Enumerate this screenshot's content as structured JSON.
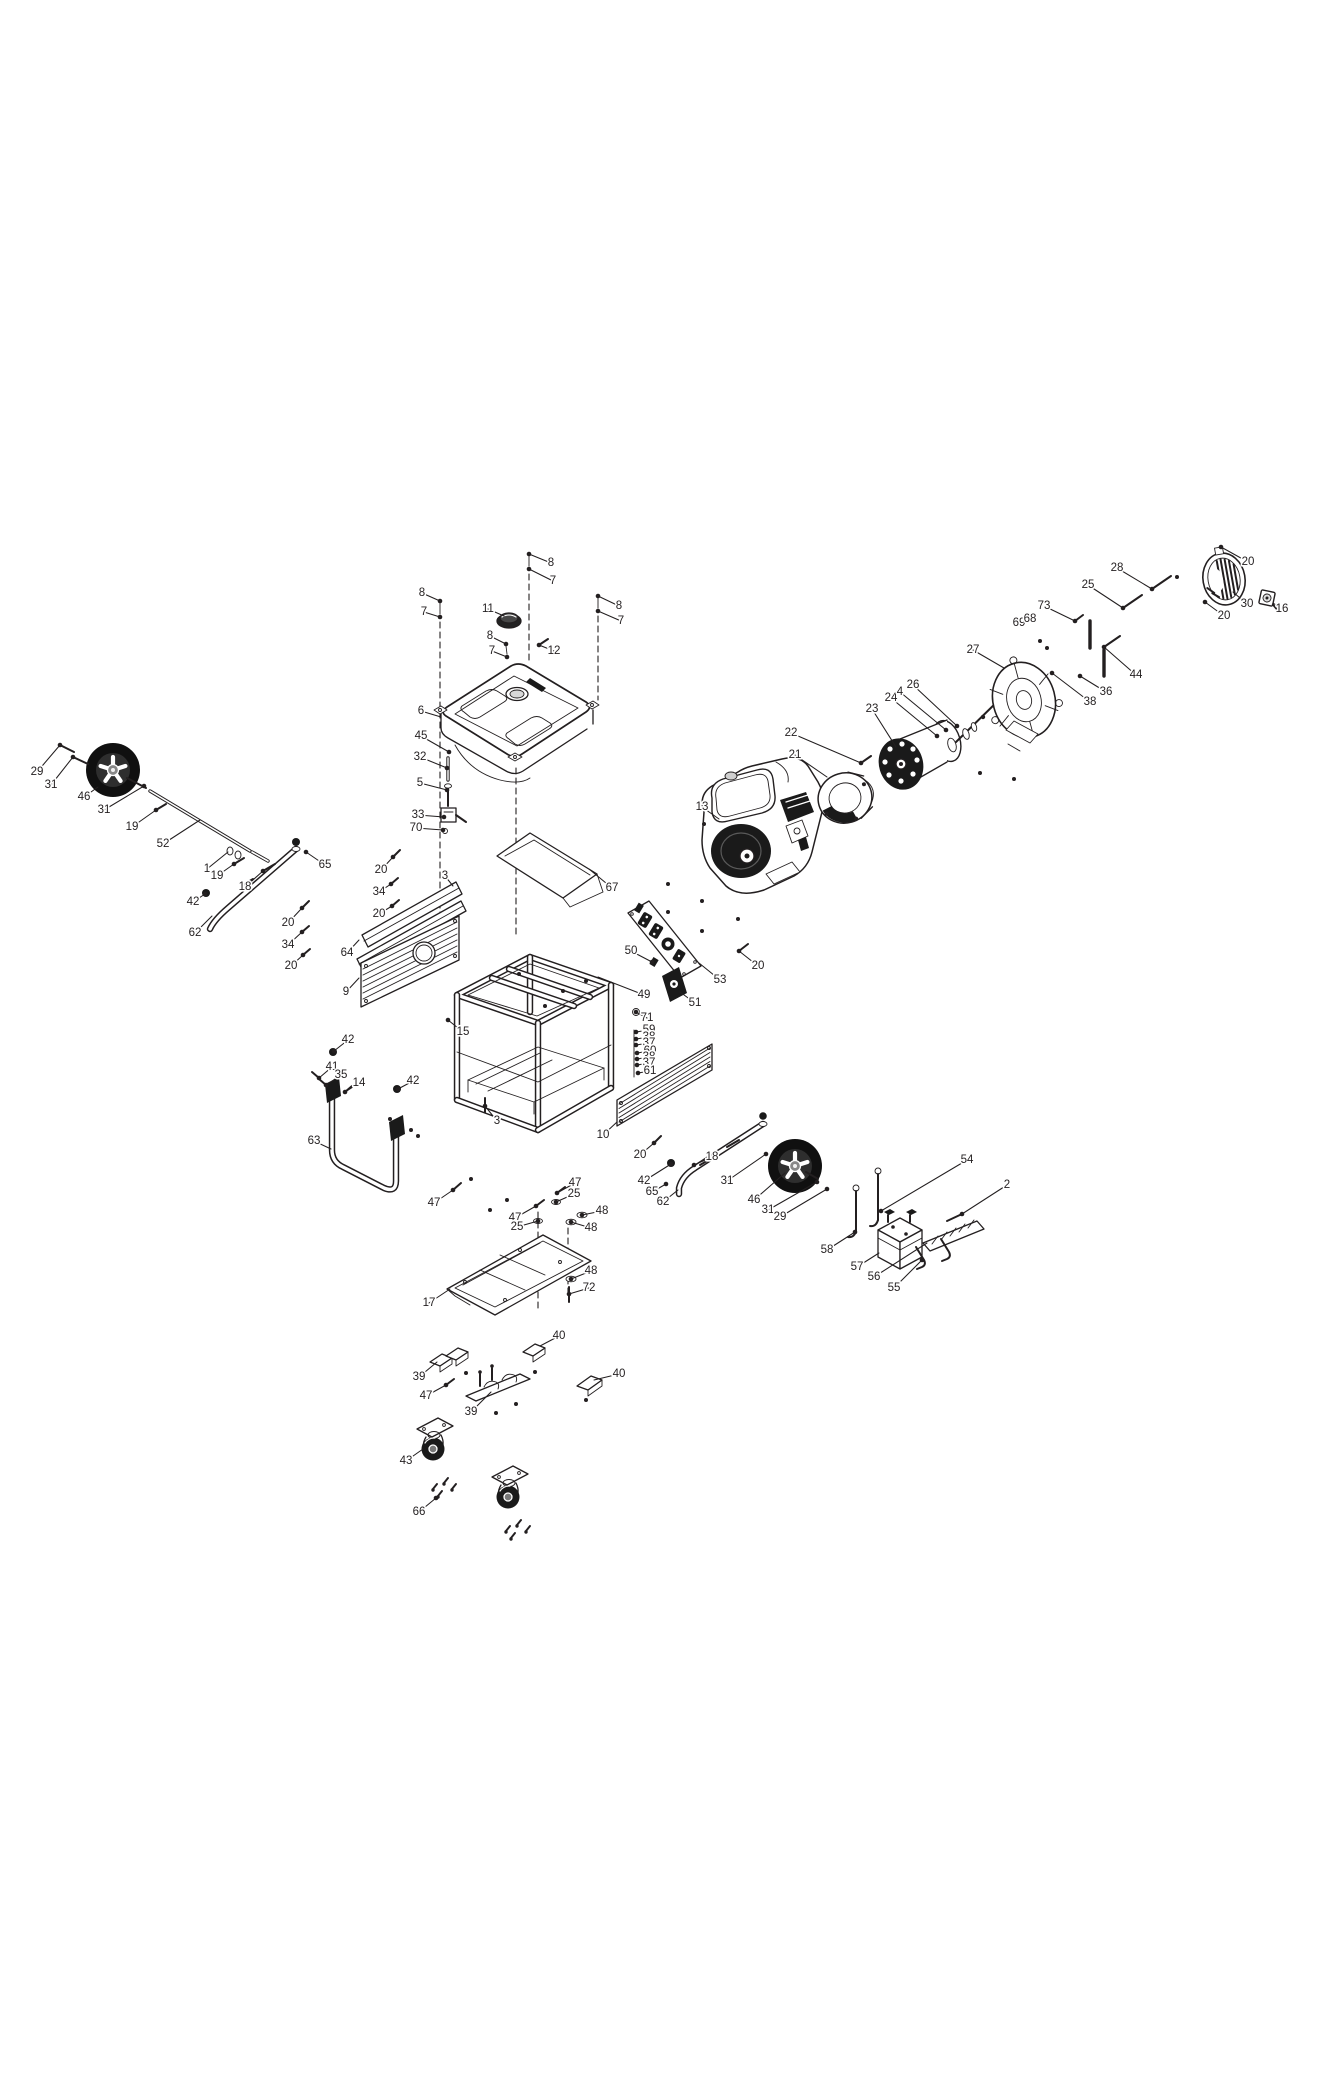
{
  "diagram": {
    "background": "#ffffff",
    "line_color": "#231f20",
    "callouts": [
      {
        "n": "8",
        "x": 422,
        "y": 593,
        "tx": 440,
        "ty": 601,
        "d": 1
      },
      {
        "n": "7",
        "x": 424,
        "y": 612,
        "tx": 440,
        "ty": 617,
        "d": 1
      },
      {
        "n": "8",
        "x": 551,
        "y": 563,
        "tx": 529,
        "ty": 554,
        "d": 1
      },
      {
        "n": "7",
        "x": 553,
        "y": 581,
        "tx": 529,
        "ty": 569,
        "d": 1
      },
      {
        "n": "8",
        "x": 619,
        "y": 606,
        "tx": 598,
        "ty": 596,
        "d": 1
      },
      {
        "n": "7",
        "x": 621,
        "y": 621,
        "tx": 598,
        "ty": 611,
        "d": 1
      },
      {
        "n": "11",
        "x": 488,
        "y": 609,
        "tx": 504,
        "ty": 616
      },
      {
        "n": "12",
        "x": 554,
        "y": 651,
        "tx": 539,
        "ty": 645,
        "d": 1
      },
      {
        "n": "8",
        "x": 490,
        "y": 636,
        "tx": 506,
        "ty": 644,
        "d": 1
      },
      {
        "n": "7",
        "x": 492,
        "y": 651,
        "tx": 507,
        "ty": 657,
        "d": 1
      },
      {
        "n": "6",
        "x": 421,
        "y": 711,
        "tx": 441,
        "ty": 717
      },
      {
        "n": "45",
        "x": 421,
        "y": 736,
        "tx": 449,
        "ty": 752,
        "d": 1
      },
      {
        "n": "32",
        "x": 420,
        "y": 757,
        "tx": 447,
        "ty": 768,
        "d": 1
      },
      {
        "n": "5",
        "x": 420,
        "y": 783,
        "tx": 447,
        "ty": 790,
        "d": 1
      },
      {
        "n": "33",
        "x": 418,
        "y": 815,
        "tx": 444,
        "ty": 817,
        "d": 1
      },
      {
        "n": "70",
        "x": 416,
        "y": 828,
        "tx": 443,
        "ty": 830,
        "d": 1
      },
      {
        "n": "29",
        "x": 37,
        "y": 772,
        "tx": 60,
        "ty": 745,
        "d": 1
      },
      {
        "n": "31",
        "x": 51,
        "y": 785,
        "tx": 73,
        "ty": 757,
        "d": 1
      },
      {
        "n": "46",
        "x": 84,
        "y": 797,
        "tx": 98,
        "ty": 787
      },
      {
        "n": "31",
        "x": 104,
        "y": 810,
        "tx": 144,
        "ty": 786,
        "d": 1
      },
      {
        "n": "19",
        "x": 132,
        "y": 827,
        "tx": 156,
        "ty": 810,
        "d": 1
      },
      {
        "n": "52",
        "x": 163,
        "y": 844,
        "tx": 200,
        "ty": 820
      },
      {
        "n": "1",
        "x": 207,
        "y": 869,
        "tx": 228,
        "ty": 852
      },
      {
        "n": "19",
        "x": 217,
        "y": 876,
        "tx": 234,
        "ty": 864,
        "d": 1
      },
      {
        "n": "18",
        "x": 245,
        "y": 887,
        "tx": 263,
        "ty": 871,
        "d": 1
      },
      {
        "n": "42",
        "x": 193,
        "y": 902,
        "tx": 205,
        "ty": 894,
        "d": 1
      },
      {
        "n": "62",
        "x": 195,
        "y": 933,
        "tx": 212,
        "ty": 916
      },
      {
        "n": "65",
        "x": 325,
        "y": 865,
        "tx": 306,
        "ty": 852,
        "d": 1
      },
      {
        "n": "20",
        "x": 288,
        "y": 923,
        "tx": 302,
        "ty": 908,
        "d": 1
      },
      {
        "n": "34",
        "x": 288,
        "y": 945,
        "tx": 302,
        "ty": 932,
        "d": 1
      },
      {
        "n": "20",
        "x": 291,
        "y": 966,
        "tx": 303,
        "ty": 955,
        "d": 1
      },
      {
        "n": "20",
        "x": 381,
        "y": 870,
        "tx": 393,
        "ty": 857,
        "d": 1
      },
      {
        "n": "34",
        "x": 379,
        "y": 892,
        "tx": 391,
        "ty": 884,
        "d": 1
      },
      {
        "n": "20",
        "x": 379,
        "y": 914,
        "tx": 392,
        "ty": 906,
        "d": 1
      },
      {
        "n": "3",
        "x": 445,
        "y": 876,
        "tx": 453,
        "ty": 886
      },
      {
        "n": "64",
        "x": 347,
        "y": 953,
        "tx": 359,
        "ty": 940
      },
      {
        "n": "9",
        "x": 346,
        "y": 992,
        "tx": 359,
        "ty": 978
      },
      {
        "n": "67",
        "x": 612,
        "y": 888,
        "tx": 589,
        "ty": 869
      },
      {
        "n": "15",
        "x": 463,
        "y": 1032,
        "tx": 448,
        "ty": 1020,
        "d": 1
      },
      {
        "n": "3",
        "x": 497,
        "y": 1121,
        "tx": 485,
        "ty": 1106,
        "d": 1
      },
      {
        "n": "42",
        "x": 348,
        "y": 1040,
        "tx": 334,
        "ty": 1051,
        "d": 1
      },
      {
        "n": "41",
        "x": 332,
        "y": 1067,
        "tx": 319,
        "ty": 1078,
        "d": 1
      },
      {
        "n": "35",
        "x": 341,
        "y": 1075,
        "tx": 326,
        "ty": 1085,
        "d": 1
      },
      {
        "n": "14",
        "x": 359,
        "y": 1083,
        "tx": 345,
        "ty": 1092,
        "d": 1
      },
      {
        "n": "63",
        "x": 314,
        "y": 1141,
        "tx": 331,
        "ty": 1149
      },
      {
        "n": "42",
        "x": 413,
        "y": 1081,
        "tx": 398,
        "ty": 1089,
        "d": 1
      },
      {
        "n": "50",
        "x": 631,
        "y": 951,
        "tx": 652,
        "ty": 962,
        "d": 1
      },
      {
        "n": "49",
        "x": 644,
        "y": 995,
        "tx": 598,
        "ty": 977
      },
      {
        "n": "53",
        "x": 720,
        "y": 980,
        "tx": 699,
        "ty": 963
      },
      {
        "n": "51",
        "x": 695,
        "y": 1003,
        "tx": 680,
        "ty": 992
      },
      {
        "n": "71",
        "x": 647,
        "y": 1018,
        "tx": 636,
        "ty": 1012,
        "d": 1
      },
      {
        "n": "59",
        "x": 649,
        "y": 1030,
        "tx": 636,
        "ty": 1032,
        "d": 1
      },
      {
        "n": "38",
        "x": 649,
        "y": 1037,
        "tx": 636,
        "ty": 1039,
        "d": 1
      },
      {
        "n": "37",
        "x": 649,
        "y": 1043,
        "tx": 636,
        "ty": 1045,
        "d": 1
      },
      {
        "n": "60",
        "x": 650,
        "y": 1051,
        "tx": 637,
        "ty": 1053,
        "d": 1
      },
      {
        "n": "38",
        "x": 649,
        "y": 1057,
        "tx": 637,
        "ty": 1059,
        "d": 1
      },
      {
        "n": "37",
        "x": 649,
        "y": 1063,
        "tx": 637,
        "ty": 1065,
        "d": 1
      },
      {
        "n": "61",
        "x": 650,
        "y": 1071,
        "tx": 638,
        "ty": 1073,
        "d": 1
      },
      {
        "n": "10",
        "x": 603,
        "y": 1135,
        "tx": 617,
        "ty": 1122
      },
      {
        "n": "20",
        "x": 640,
        "y": 1155,
        "tx": 654,
        "ty": 1143,
        "d": 1
      },
      {
        "n": "20",
        "x": 758,
        "y": 966,
        "tx": 739,
        "ty": 951,
        "d": 1
      },
      {
        "n": "13",
        "x": 702,
        "y": 807,
        "tx": 719,
        "ty": 819
      },
      {
        "n": "22",
        "x": 791,
        "y": 733,
        "tx": 861,
        "ty": 763,
        "d": 1
      },
      {
        "n": "21",
        "x": 795,
        "y": 755,
        "tx": 827,
        "ty": 777
      },
      {
        "n": "23",
        "x": 872,
        "y": 709,
        "tx": 896,
        "ty": 747
      },
      {
        "n": "24",
        "x": 891,
        "y": 698,
        "tx": 937,
        "ty": 736,
        "d": 1
      },
      {
        "n": "4",
        "x": 900,
        "y": 692,
        "tx": 946,
        "ty": 730,
        "d": 1
      },
      {
        "n": "26",
        "x": 913,
        "y": 685,
        "tx": 957,
        "ty": 726,
        "d": 1
      },
      {
        "n": "27",
        "x": 973,
        "y": 650,
        "tx": 1004,
        "ty": 668
      },
      {
        "n": "73",
        "x": 1044,
        "y": 606,
        "tx": 1075,
        "ty": 621,
        "d": 1
      },
      {
        "n": "69",
        "x": 1019,
        "y": 623
      },
      {
        "n": "68",
        "x": 1030,
        "y": 619
      },
      {
        "n": "38",
        "x": 1090,
        "y": 702,
        "tx": 1052,
        "ty": 673,
        "d": 1
      },
      {
        "n": "36",
        "x": 1106,
        "y": 692,
        "tx": 1080,
        "ty": 676,
        "d": 1
      },
      {
        "n": "44",
        "x": 1136,
        "y": 675,
        "tx": 1104,
        "ty": 647,
        "d": 1
      },
      {
        "n": "25",
        "x": 1088,
        "y": 585,
        "tx": 1123,
        "ty": 608,
        "d": 1
      },
      {
        "n": "28",
        "x": 1117,
        "y": 568,
        "tx": 1152,
        "ty": 589,
        "d": 1
      },
      {
        "n": "20",
        "x": 1248,
        "y": 562,
        "tx": 1221,
        "ty": 547,
        "d": 1
      },
      {
        "n": "30",
        "x": 1247,
        "y": 604,
        "tx": 1233,
        "ty": 592
      },
      {
        "n": "16",
        "x": 1282,
        "y": 609,
        "tx": 1273,
        "ty": 603
      },
      {
        "n": "20",
        "x": 1224,
        "y": 616,
        "tx": 1205,
        "ty": 602,
        "d": 1
      },
      {
        "n": "18",
        "x": 712,
        "y": 1157,
        "tx": 694,
        "ty": 1165,
        "d": 1
      },
      {
        "n": "42",
        "x": 644,
        "y": 1181,
        "tx": 671,
        "ty": 1164,
        "d": 1
      },
      {
        "n": "65",
        "x": 652,
        "y": 1192,
        "tx": 666,
        "ty": 1184,
        "d": 1
      },
      {
        "n": "62",
        "x": 663,
        "y": 1202,
        "tx": 678,
        "ty": 1190
      },
      {
        "n": "31",
        "x": 727,
        "y": 1181,
        "tx": 766,
        "ty": 1154,
        "d": 1
      },
      {
        "n": "46",
        "x": 754,
        "y": 1200,
        "tx": 785,
        "ty": 1173
      },
      {
        "n": "31",
        "x": 768,
        "y": 1210,
        "tx": 817,
        "ty": 1182,
        "d": 1
      },
      {
        "n": "29",
        "x": 780,
        "y": 1217,
        "tx": 827,
        "ty": 1189,
        "d": 1
      },
      {
        "n": "54",
        "x": 967,
        "y": 1160,
        "tx": 881,
        "ty": 1211,
        "d": 1
      },
      {
        "n": "2",
        "x": 1007,
        "y": 1185,
        "tx": 962,
        "ty": 1214,
        "d": 1
      },
      {
        "n": "58",
        "x": 827,
        "y": 1250,
        "tx": 855,
        "ty": 1232,
        "d": 1
      },
      {
        "n": "57",
        "x": 857,
        "y": 1267,
        "tx": 879,
        "ty": 1253
      },
      {
        "n": "56",
        "x": 874,
        "y": 1277,
        "tx": 927,
        "ty": 1243
      },
      {
        "n": "55",
        "x": 894,
        "y": 1288,
        "tx": 922,
        "ty": 1260,
        "d": 1
      },
      {
        "n": "47",
        "x": 434,
        "y": 1203,
        "tx": 453,
        "ty": 1190,
        "d": 1
      },
      {
        "n": "47",
        "x": 575,
        "y": 1183,
        "tx": 557,
        "ty": 1193,
        "d": 1
      },
      {
        "n": "25",
        "x": 574,
        "y": 1194,
        "tx": 556,
        "ty": 1202,
        "d": 1
      },
      {
        "n": "47",
        "x": 515,
        "y": 1218,
        "tx": 536,
        "ty": 1206,
        "d": 1
      },
      {
        "n": "25",
        "x": 517,
        "y": 1227,
        "tx": 538,
        "ty": 1221,
        "d": 1
      },
      {
        "n": "48",
        "x": 602,
        "y": 1211,
        "tx": 582,
        "ty": 1215,
        "d": 1
      },
      {
        "n": "48",
        "x": 591,
        "y": 1228,
        "tx": 571,
        "ty": 1222,
        "d": 1
      },
      {
        "n": "48",
        "x": 591,
        "y": 1271,
        "tx": 571,
        "ty": 1279,
        "d": 1
      },
      {
        "n": "72",
        "x": 589,
        "y": 1288,
        "tx": 569,
        "ty": 1294,
        "d": 1
      },
      {
        "n": "17",
        "x": 429,
        "y": 1303,
        "tx": 450,
        "ty": 1289
      },
      {
        "n": "40",
        "x": 559,
        "y": 1336,
        "tx": 540,
        "ty": 1346
      },
      {
        "n": "39",
        "x": 419,
        "y": 1377,
        "tx": 437,
        "ty": 1362
      },
      {
        "n": "47",
        "x": 426,
        "y": 1396,
        "tx": 446,
        "ty": 1385,
        "d": 1
      },
      {
        "n": "39",
        "x": 471,
        "y": 1412,
        "tx": 491,
        "ty": 1392
      },
      {
        "n": "40",
        "x": 619,
        "y": 1374,
        "tx": 594,
        "ty": 1380
      },
      {
        "n": "43",
        "x": 406,
        "y": 1461,
        "tx": 423,
        "ty": 1449
      },
      {
        "n": "66",
        "x": 419,
        "y": 1512,
        "tx": 436,
        "ty": 1498,
        "d": 1
      }
    ]
  }
}
